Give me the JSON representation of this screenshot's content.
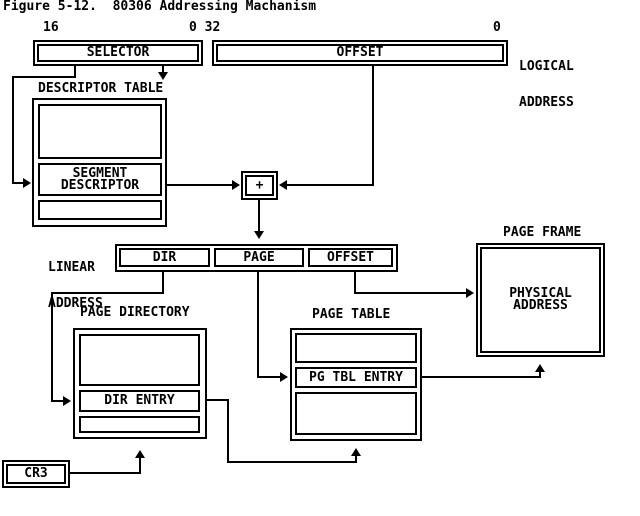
{
  "title": "Figure 5-12.  80306 Addressing Machanism",
  "bit_markers": {
    "high_16": "16",
    "mid_0_32": "0 32",
    "low_0": "0"
  },
  "logical_address": {
    "label_line1": "LOGICAL",
    "label_line2": "ADDRESS",
    "selector_label": "SELECTOR",
    "offset_label": "OFFSET"
  },
  "descriptor_table": {
    "title": "DESCRIPTOR TABLE",
    "entry_line1": "SEGMENT",
    "entry_line2": "DESCRIPTOR"
  },
  "adder": {
    "symbol": "+"
  },
  "linear_address": {
    "label_line1": "LINEAR",
    "label_line2": "ADDRESS",
    "fields": [
      {
        "label": "DIR"
      },
      {
        "label": "PAGE"
      },
      {
        "label": "OFFSET"
      }
    ]
  },
  "page_frame": {
    "title": "PAGE FRAME",
    "content_line1": "PHYSICAL",
    "content_line2": "ADDRESS"
  },
  "page_directory": {
    "title": "PAGE DIRECTORY",
    "entry_label": "DIR ENTRY"
  },
  "page_table": {
    "title": "PAGE TABLE",
    "entry_label": "PG TBL ENTRY"
  },
  "register": {
    "label": "CR3"
  },
  "colors": {
    "ink": "#000000",
    "paper": "#ffffff"
  }
}
